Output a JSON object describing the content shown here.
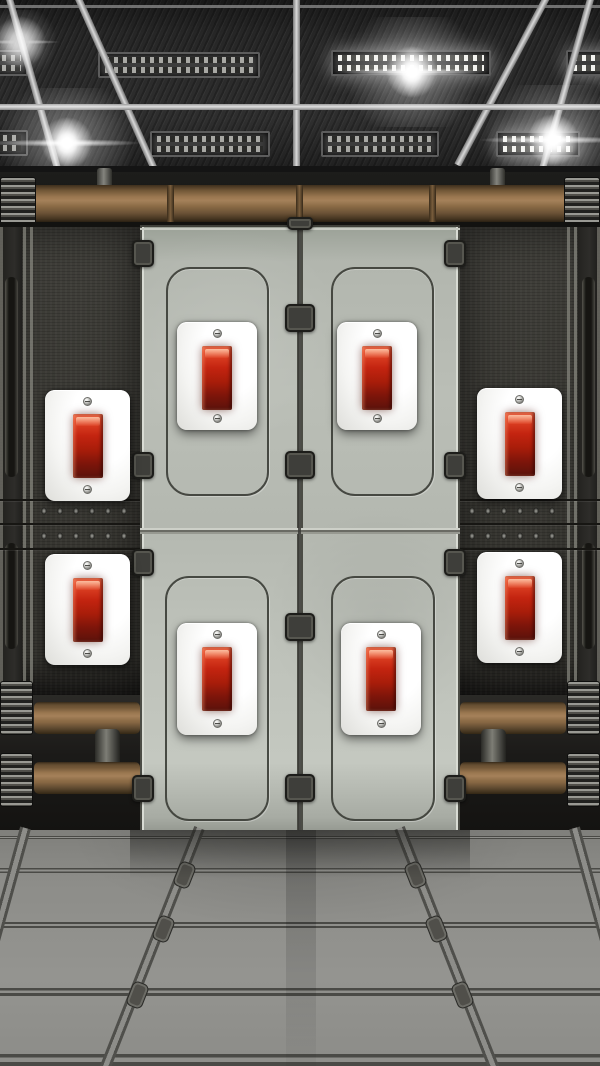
{
  "scene": {
    "name": "sci-fi-corridor-door-room",
    "description": "Escape-room style puzzle screen: closed grey metal double door in a dark sci-fi corridor, eight identical red rocker light switches mounted on the door leaves and the side walls, lit ceiling with lens-flare lamps, brown pipes and a tiled grey floor",
    "visible_text": ""
  },
  "door": {
    "label": "metal double door",
    "state": "closed",
    "leaves": [
      "left",
      "right"
    ],
    "inset_panels": 4,
    "clips": 13
  },
  "switches": [
    {
      "id": "door-top-left",
      "label": "switch on left door leaf, upper",
      "color": "red",
      "state": "down"
    },
    {
      "id": "door-top-right",
      "label": "switch on right door leaf, upper",
      "color": "red",
      "state": "down"
    },
    {
      "id": "door-bottom-left",
      "label": "switch on left door leaf, lower",
      "color": "red",
      "state": "down"
    },
    {
      "id": "door-bottom-right",
      "label": "switch on right door leaf, lower",
      "color": "red",
      "state": "down"
    },
    {
      "id": "wall-top-left",
      "label": "switch on left wall, upper",
      "color": "red",
      "state": "down"
    },
    {
      "id": "wall-top-right",
      "label": "switch on right wall, upper",
      "color": "red",
      "state": "down"
    },
    {
      "id": "wall-bottom-left",
      "label": "switch on left wall, lower",
      "color": "red",
      "state": "down"
    },
    {
      "id": "wall-bottom-right",
      "label": "switch on right wall, lower",
      "color": "red",
      "state": "down"
    }
  ],
  "ceiling_lights": {
    "count": 3,
    "style": "white lens flares",
    "positions": [
      "left",
      "center",
      "right"
    ]
  },
  "pipes": {
    "top_band": 1,
    "bottom_left": 2,
    "bottom_right": 2,
    "color": "brown"
  },
  "palette": {
    "ceiling": "#2c2c2c",
    "beam": "#d9d9d9",
    "wall": "#3b3a36",
    "pipe_brown": "#8a6a45",
    "door_gray": "#b6bab2",
    "plate_white": "#fafaf8",
    "switch_red": "#c42410",
    "switch_red_bright": "#ef6a49",
    "switch_red_deep": "#5a120b",
    "floor_gray": "#8d8d8b"
  }
}
